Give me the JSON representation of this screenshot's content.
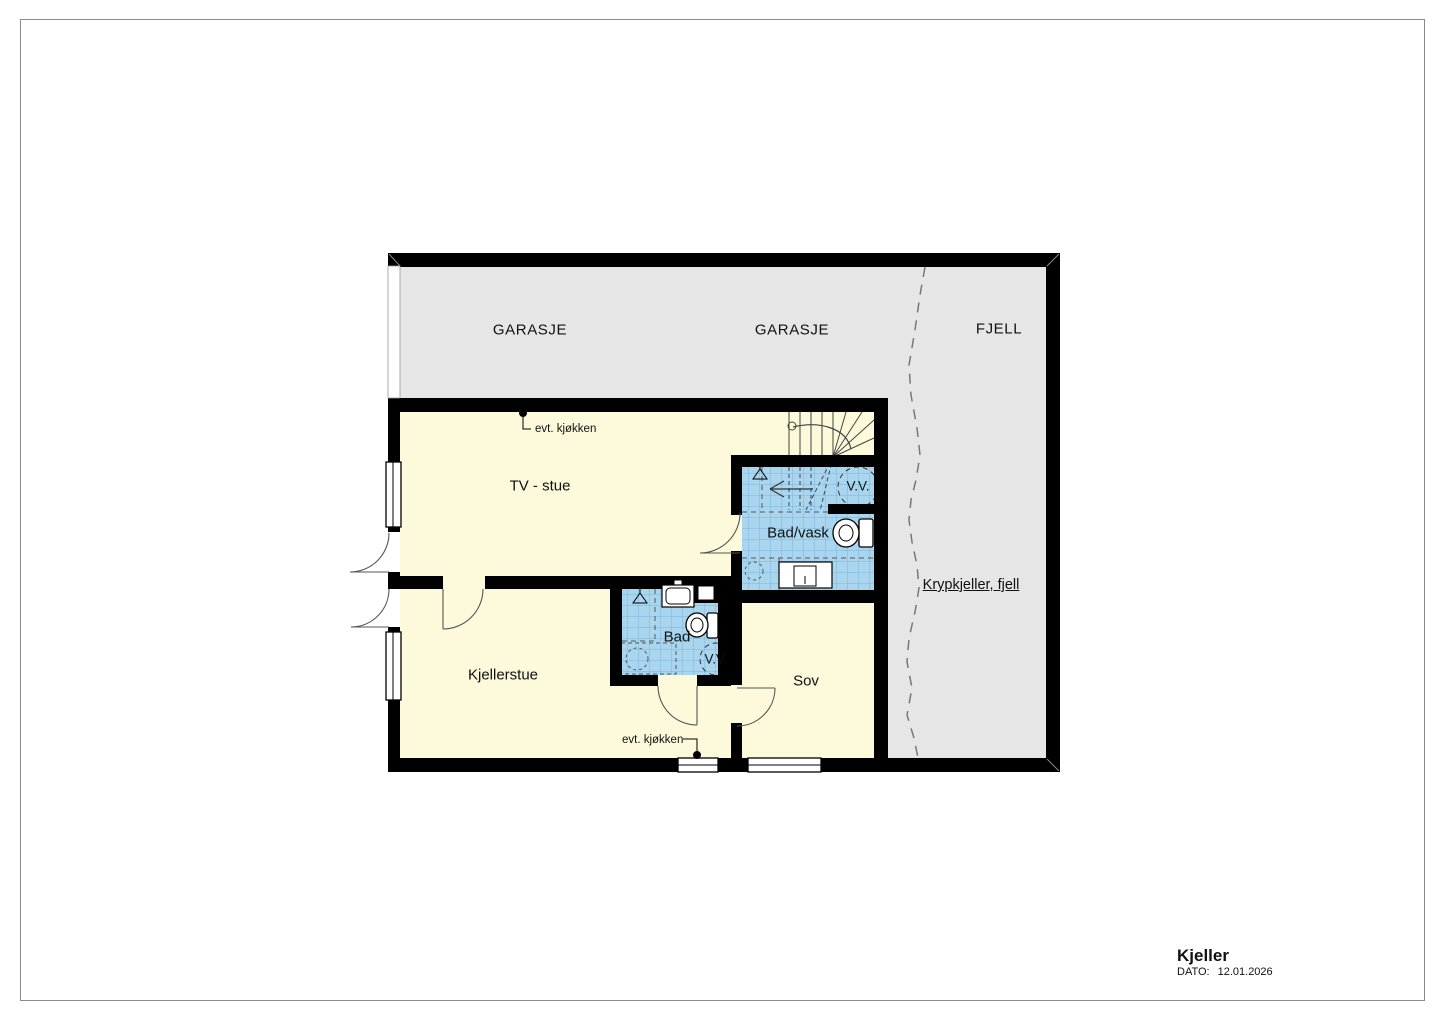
{
  "palette": {
    "wall": "#000000",
    "garage_fill": "#e6e6e6",
    "room_fill": "#fcfada",
    "tile_fill": "#a9d5ef",
    "tile_line": "#7cb5d8",
    "thin_line": "#555555",
    "fjell_dash": "#777777"
  },
  "rooms": {
    "garage_left": "GARASJE",
    "garage_right": "GARASJE",
    "fjell": "FJELL",
    "tv_stue": "TV - stue",
    "bad_vask": "Bad/vask",
    "bad": "Bad",
    "kjellerstue": "Kjellerstue",
    "sov": "Sov",
    "krypkjeller": "Krypkjeller, fjell"
  },
  "annotations": {
    "evt_kjokken_top": "evt. kjøkken",
    "evt_kjokken_bottom": "evt. kjøkken",
    "vv_bad_vask": "V.V.",
    "vv_bad": "V.V."
  },
  "title_block": {
    "title": "Kjeller",
    "date_label": "DATO:",
    "date": "12.01.2026"
  }
}
